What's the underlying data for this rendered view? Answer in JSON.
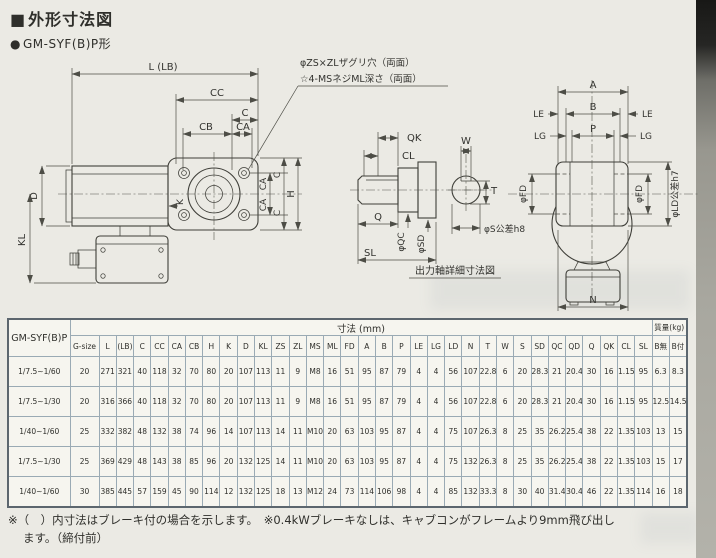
{
  "page": {
    "title": "外形寸法図",
    "title_bullet": "■",
    "subtitle": "GM-SYF(B)P形",
    "subtitle_bullet": "●"
  },
  "drawing": {
    "annotations": {
      "counterbore": "φZS×ZLザグリ穴（両面）",
      "screws": "☆4-MSネジML深さ（両面）"
    },
    "left_view": {
      "l": "L (LB)",
      "cc": "CC",
      "c": "C",
      "cb": "CB",
      "ca": "CA",
      "d": "D",
      "kl": "KL",
      "k": "K",
      "ca_top": "CA",
      "ca_bottom": "CA",
      "c_top": "C",
      "c_bottom": "C",
      "h": "H"
    },
    "shaft_detail": {
      "qk": "QK",
      "cl": "CL",
      "q": "Q",
      "sl": "SL",
      "qc": "φQC",
      "sd": "φSD",
      "w": "W",
      "t": "T",
      "s": "φS公差h8",
      "caption": "出力軸詳細寸法図"
    },
    "right_view": {
      "a": "A",
      "b": "B",
      "p": "P",
      "le_left": "LE",
      "le_right": "LE",
      "lg_left": "LG",
      "lg_right": "LG",
      "fd_left": "φFD",
      "fd_right": "φFD",
      "ld": "φLD公差h7",
      "n": "N"
    }
  },
  "table": {
    "corner": "GM-SYF(B)P",
    "dim_header": "寸法 (mm)",
    "mass_header": "質量(kg)",
    "columns": [
      "G-size",
      "L",
      "(LB)",
      "C",
      "CC",
      "CA",
      "CB",
      "H",
      "K",
      "D",
      "KL",
      "ZS",
      "ZL",
      "MS",
      "ML",
      "FD",
      "A",
      "B",
      "P",
      "LE",
      "LG",
      "LD",
      "N",
      "T",
      "W",
      "S",
      "SD",
      "QC",
      "QD",
      "Q",
      "QK",
      "CL",
      "SL",
      "B無",
      "B付"
    ],
    "rows": [
      {
        "ratio": "1/7.5~1/60",
        "values": [
          "20",
          "271",
          "321",
          "40",
          "118",
          "32",
          "70",
          "80",
          "20",
          "107",
          "113",
          "11",
          "9",
          "M8",
          "16",
          "51",
          "95",
          "87",
          "79",
          "4",
          "4",
          "56",
          "107",
          "22.8",
          "6",
          "20",
          "28.3",
          "21",
          "20.4",
          "30",
          "16",
          "1.15",
          "95",
          "6.3",
          "8.3"
        ]
      },
      {
        "ratio": "1/7.5~1/30",
        "values": [
          "20",
          "316",
          "366",
          "40",
          "118",
          "32",
          "70",
          "80",
          "20",
          "107",
          "113",
          "11",
          "9",
          "M8",
          "16",
          "51",
          "95",
          "87",
          "79",
          "4",
          "4",
          "56",
          "107",
          "22.8",
          "6",
          "20",
          "28.3",
          "21",
          "20.4",
          "30",
          "16",
          "1.15",
          "95",
          "12.5",
          "14.5"
        ]
      },
      {
        "ratio": "1/40~1/60",
        "values": [
          "25",
          "332",
          "382",
          "48",
          "132",
          "38",
          "74",
          "96",
          "14",
          "107",
          "113",
          "14",
          "11",
          "M10",
          "20",
          "63",
          "103",
          "95",
          "87",
          "4",
          "4",
          "75",
          "107",
          "26.3",
          "8",
          "25",
          "35",
          "26.2",
          "25.4",
          "38",
          "22",
          "1.35",
          "103",
          "13",
          "15"
        ]
      },
      {
        "ratio": "1/7.5~1/30",
        "values": [
          "25",
          "369",
          "429",
          "48",
          "143",
          "38",
          "85",
          "96",
          "20",
          "132",
          "125",
          "14",
          "11",
          "M10",
          "20",
          "63",
          "103",
          "95",
          "87",
          "4",
          "4",
          "75",
          "132",
          "26.3",
          "8",
          "25",
          "35",
          "26.2",
          "25.4",
          "38",
          "22",
          "1.35",
          "103",
          "15",
          "17"
        ]
      },
      {
        "ratio": "1/40~1/60",
        "values": [
          "30",
          "385",
          "445",
          "57",
          "159",
          "45",
          "90",
          "114",
          "12",
          "132",
          "125",
          "18",
          "13",
          "M12",
          "24",
          "73",
          "114",
          "106",
          "98",
          "4",
          "4",
          "85",
          "132",
          "33.3",
          "8",
          "30",
          "40",
          "31.4",
          "30.4",
          "46",
          "22",
          "1.35",
          "114",
          "16",
          "18"
        ]
      }
    ]
  },
  "notes": {
    "line1": "※（　）内寸法はブレーキ付の場合を示します。　※0.4kWブレーキなしは、キャブコンがフレームより9mm飛び出し",
    "line2": "ます。（締付前）"
  },
  "colors": {
    "paper": "#ebeae4",
    "ink": "#2f2f2b",
    "grid": "#9aaab4",
    "edge_shadow": "#262624"
  }
}
